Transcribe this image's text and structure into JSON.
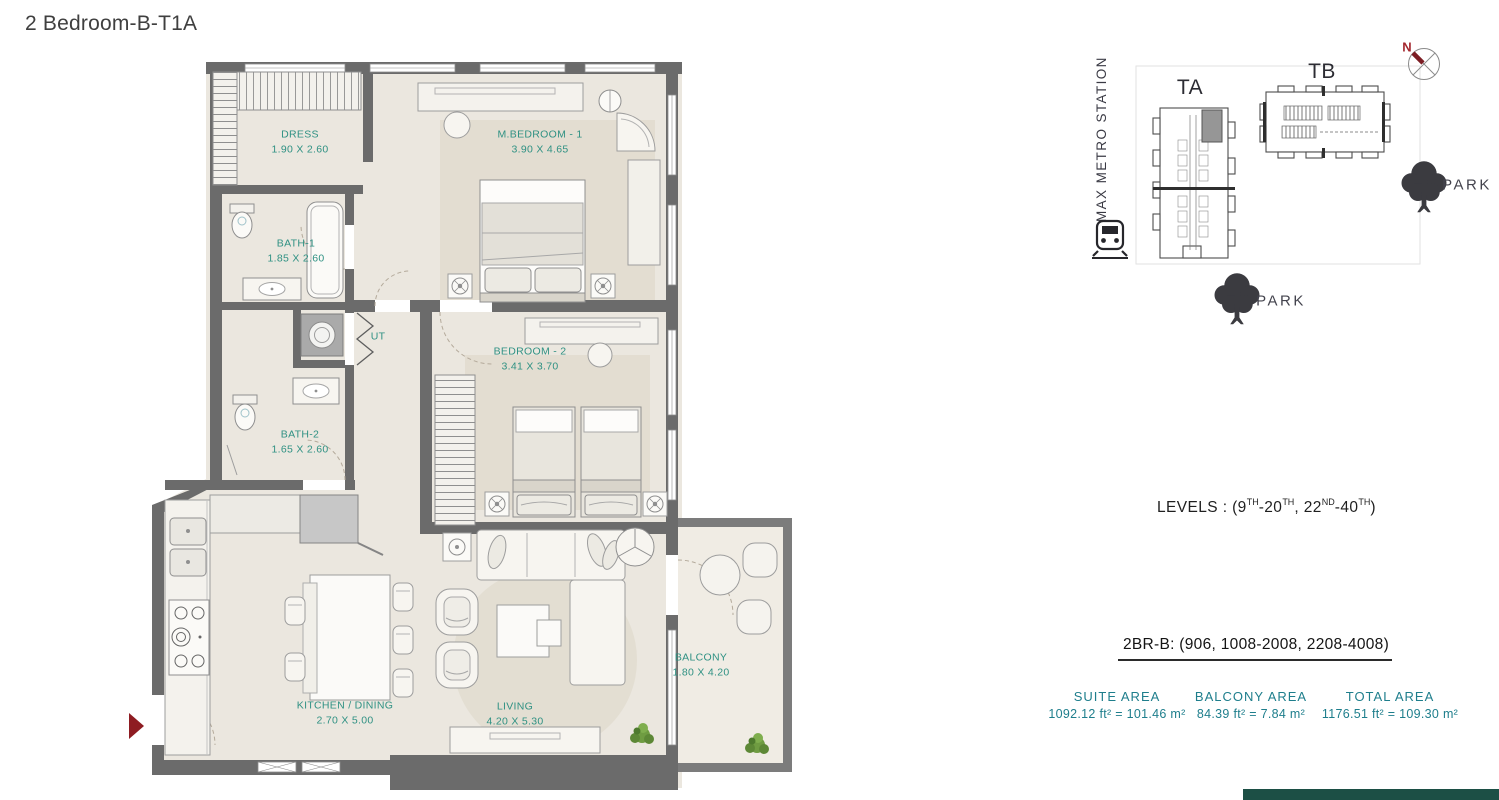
{
  "title": "2 Bedroom-B-T1A",
  "floor_plan": {
    "rooms": [
      {
        "label": "DRESS",
        "dims": "1.90 X 2.60"
      },
      {
        "label": "M.BEDROOM - 1",
        "dims": "3.90 X 4.65"
      },
      {
        "label": "BATH-1",
        "dims": "1.85 X 2.60"
      },
      {
        "label": "UT",
        "dims": ""
      },
      {
        "label": "BEDROOM - 2",
        "dims": "3.41 X 3.70"
      },
      {
        "label": "BATH-2",
        "dims": "1.65 X 2.60"
      },
      {
        "label": "KITCHEN / DINING",
        "dims": "2.70 X 5.00"
      },
      {
        "label": "LIVING",
        "dims": "4.20 X 5.30"
      },
      {
        "label": "BALCONY",
        "dims": "1.80 X 4.20"
      }
    ]
  },
  "key_plan": {
    "metro_station": "MAX METRO STATION",
    "tower_a": "TA",
    "tower_b": "TB",
    "park_right": "PARK",
    "park_bottom": "PARK",
    "compass_north": "N"
  },
  "levels": {
    "p1": "LEVELS : (9",
    "s1": "TH",
    "p2": "-20",
    "s2": "TH",
    "p3": ", 22",
    "s3": "ND",
    "p4": "-40",
    "s4": "TH",
    "p5": ")"
  },
  "unit_numbers": "2BR-B: (906, 1008-2008, 2208-4008)",
  "areas": [
    {
      "label": "SUITE AREA",
      "value": "1092.12 ft² = 101.46 m²"
    },
    {
      "label": "BALCONY AREA",
      "value": "84.39 ft² = 7.84 m²"
    },
    {
      "label": "TOTAL AREA",
      "value": "1176.51 ft² = 109.30 m²"
    }
  ],
  "colors": {
    "room_label_teal": "#2f9183",
    "stats_teal": "#1e7e8c",
    "wall_gray": "#6b6b6b",
    "entry_arrow_red": "#8e1c22",
    "compass_needle_red": "#7c1d24",
    "footer_teal": "#1c4f45"
  }
}
